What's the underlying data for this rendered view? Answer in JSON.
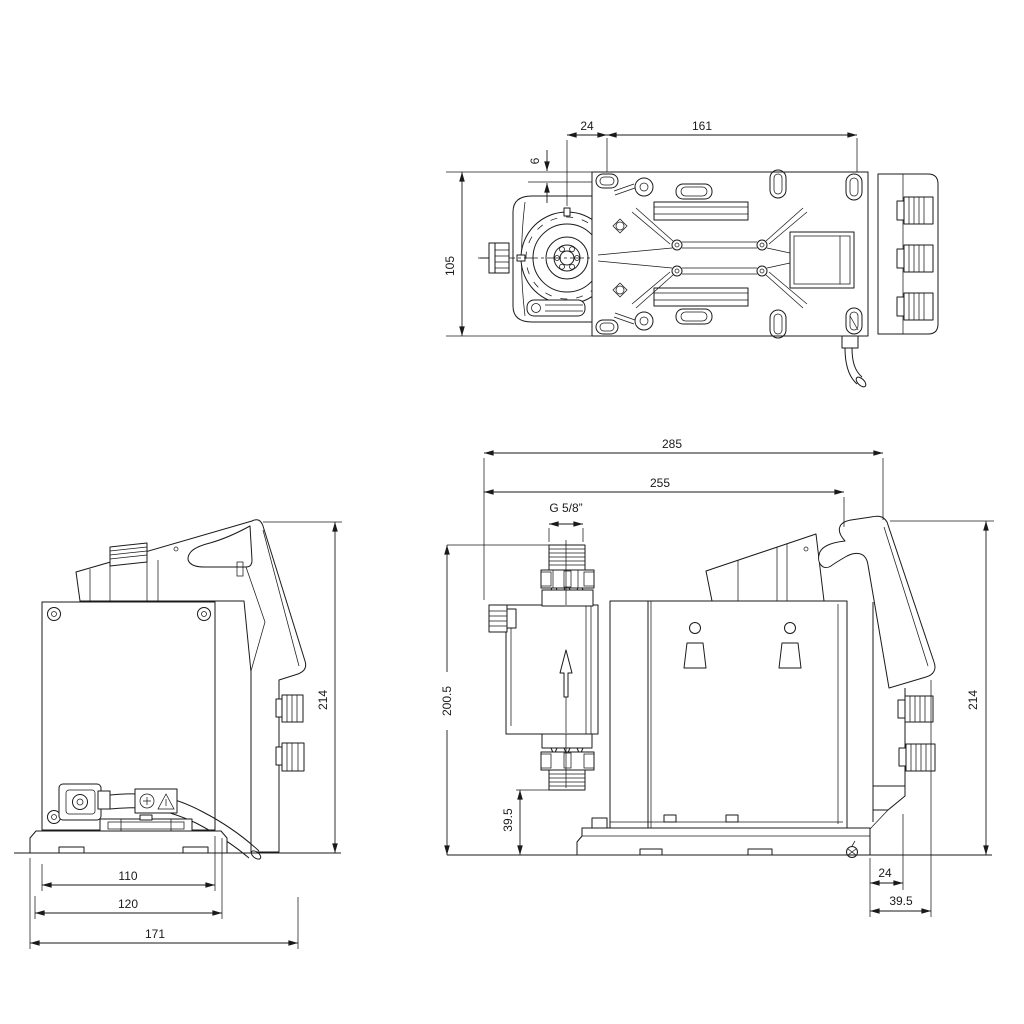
{
  "colors": {
    "line": "#1a1a1a",
    "background": "#ffffff"
  },
  "dims": {
    "top": {
      "w24": "24",
      "w161": "161",
      "h6": "6",
      "h105": "105"
    },
    "back": {
      "h214": "214",
      "w110": "110",
      "w120": "120",
      "w171": "171"
    },
    "side": {
      "w285": "285",
      "w255": "255",
      "thread": "G 5/8”",
      "h200_5": "200.5",
      "h39_5_left": "39.5",
      "h214": "214",
      "w24": "24",
      "w39_5_right": "39.5"
    }
  }
}
